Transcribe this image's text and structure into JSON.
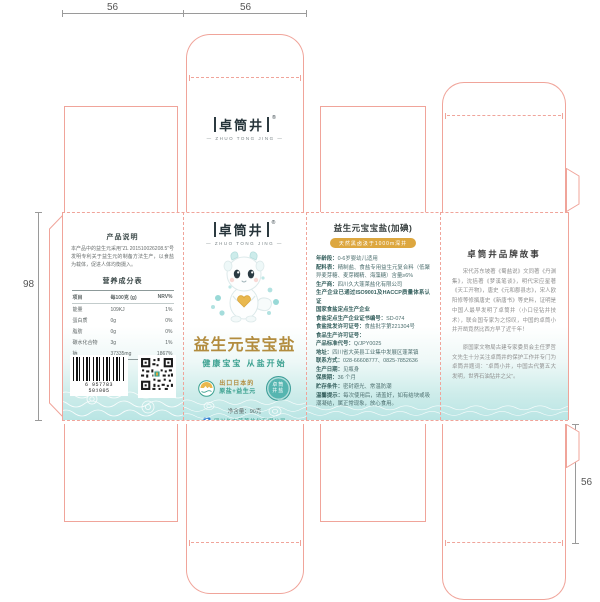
{
  "document": {
    "type": "packaging-dieline-proof"
  },
  "colors": {
    "dieline": "#f0a49a",
    "teal": "#3aa08f",
    "gold": "#b28c3e",
    "panel_teal": "#b9e5e4",
    "pill_gold": "#dda73f"
  },
  "dimensions": {
    "top_left": "56",
    "top_center": "56",
    "left": "98",
    "bottom_right": "56"
  },
  "brand": {
    "logo": "卓筒井",
    "reg": "®",
    "tagline": "— ZHUO TONG JING —"
  },
  "front_panel": {
    "title": "益生元宝宝盐",
    "subtitle": "健康宝宝 从盐开始",
    "badge_line1": "出口日本的",
    "badge_line2": "原盐+益生元",
    "seal_line1": "卓筒",
    "seal_line2": "井盐",
    "net_weight": "净含量：90克",
    "company": "四川久大蓬莱盐化有限公司"
  },
  "left_panel": {
    "desc_title": "产品说明",
    "desc_text": "本产品中的益生元采用“ZL 201510026208.5”号发明专利关于益生元的制备方法生产，以食盐为载体，促进人体均衡摄入。",
    "nutrition_title": "营养成分表",
    "table": {
      "headers": [
        "项目",
        "每100克 (g)",
        "NRV%"
      ],
      "rows": [
        [
          "能量",
          "109KJ",
          "1%"
        ],
        [
          "蛋白质",
          "0g",
          "0%"
        ],
        [
          "脂肪",
          "0g",
          "0%"
        ],
        [
          "碳水化合物",
          "3g",
          "1%"
        ],
        [
          "钠",
          "37335mg",
          "1867%"
        ]
      ]
    },
    "note": "低聚异麦芽糖含量>1%",
    "barcode_number": "6 957783 501005"
  },
  "back_panel": {
    "title": "益生元宝宝盐(加碘)",
    "pill": "天然黑卤汲于1000m深井",
    "info": [
      {
        "label": "年龄段：",
        "value": "0-6岁婴幼儿适用"
      },
      {
        "label": "配料表：",
        "value": "精制盐、食盐专用益生元复合料（低聚异麦芽糖、麦芽糊精、海藻糖）含量≥6%"
      },
      {
        "label": "生产商：",
        "value": "四川久大蓬莱盐化有限公司"
      },
      {
        "label": "",
        "value": "生产企业已通过ISO9001及HACCP质量体系认证"
      },
      {
        "label": "",
        "value": "国家食盐定点生产企业"
      },
      {
        "label": "食盐定点生产企业证书编号：",
        "value": "SD-074"
      },
      {
        "label": "食盐批发许可证号：",
        "value": "食盐批字第221304号"
      },
      {
        "label": "食品生产许可证号：",
        "value": ""
      },
      {
        "label": "产品标准代号：",
        "value": "Q/JPY0025"
      },
      {
        "label": "地址：",
        "value": "四川省大英县工业集中发展区蓬莱镇"
      },
      {
        "label": "联系方式：",
        "value": "028-66608777、0825-7852636"
      },
      {
        "label": "生产日期：",
        "value": "见瓶身"
      },
      {
        "label": "保质期：",
        "value": "36 个月"
      },
      {
        "label": "贮存条件：",
        "value": "密封避光、常温防潮"
      },
      {
        "label": "温馨提示：",
        "value": "每次使用后，请盖好，如有结块或吸潮凝结，属正常现象，放心食用。"
      }
    ]
  },
  "story_panel": {
    "title": "卓筒井品牌故事",
    "p1": "宋代苏东坡著《蜀盐说》文同著《丹渊集》，沈括著《梦溪笔谈》，明代宋应星著《天工开物》，唐史《元和郡县志》，宋人欧阳修等修撰唐史《新唐书》等史料，证明是中国人最早发明了卓筒井（小口径钻井技术），联合国专家为之惊叹，中国的卓筒小井开凿竟然比西方早了近千年！",
    "p2": "原国家文物局古建专家委员会主任罗哲文先生十分关注卓筒井的保护工作并专门为卓筒井题词：“卓筒小井，中国古代第五大发明，世界石油钻井之父”。"
  }
}
